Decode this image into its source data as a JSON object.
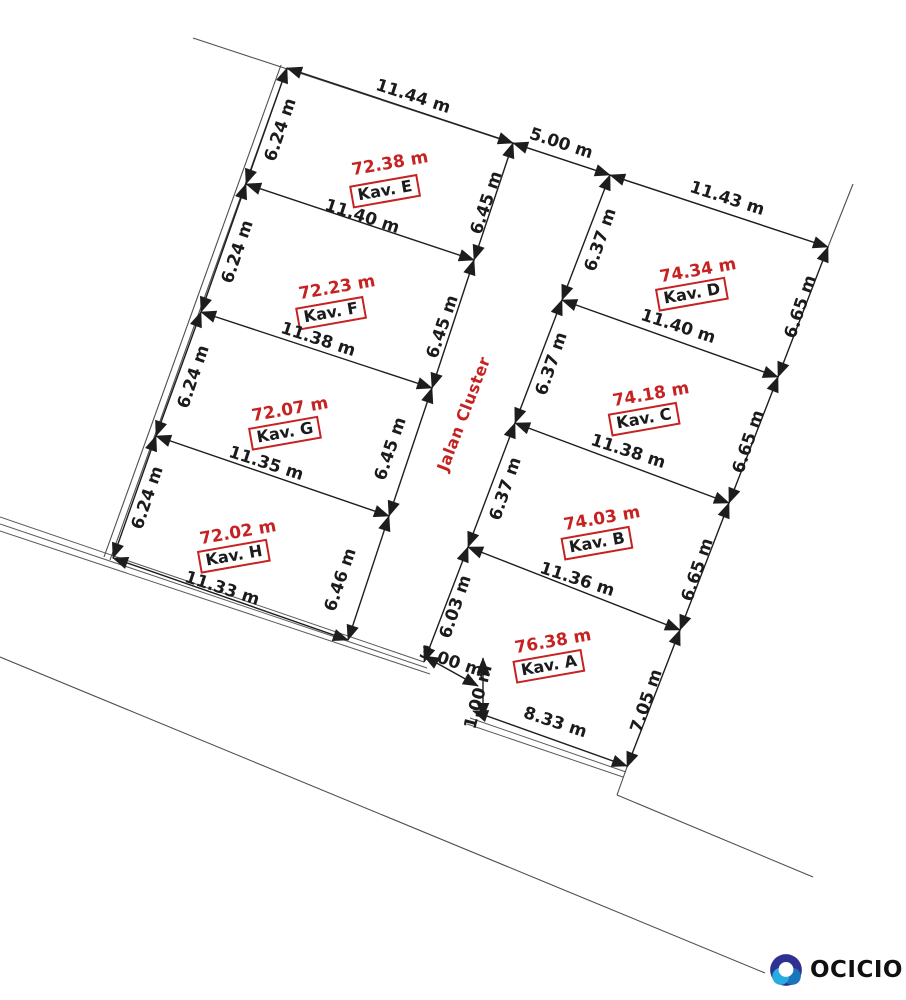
{
  "palette": {
    "accent": "#c62222",
    "text": "#1b1b1b",
    "line": "#4f4f4f",
    "logo_navy": "#2e3192",
    "logo_mid_blue": "#1b75bb",
    "logo_light_blue": "#29abe2"
  },
  "road": {
    "name": "Jalan Cluster",
    "top_width": "5.00 m",
    "bottom_width": "3.00 m",
    "edge_offset": "1.00 m"
  },
  "plots": {
    "E": {
      "kav": "Kav. E",
      "area": "72.38 m",
      "top": "11.44 m",
      "left": "6.24 m",
      "right": "6.45 m"
    },
    "F": {
      "kav": "Kav. F",
      "area": "72.23 m",
      "top": "11.40 m",
      "left": "6.24 m",
      "right": "6.45 m"
    },
    "G": {
      "kav": "Kav. G",
      "area": "72.07 m",
      "top": "11.38 m",
      "left": "6.24 m",
      "right": "6.45 m"
    },
    "H": {
      "kav": "Kav. H",
      "area": "72.02 m",
      "top": "11.35 m",
      "left": "6.24 m",
      "right": "6.46 m",
      "bottom": "11.33 m"
    },
    "D": {
      "kav": "Kav. D",
      "area": "74.34 m",
      "top": "11.43 m",
      "left": "6.37 m",
      "right": "6.65 m"
    },
    "C": {
      "kav": "Kav. C",
      "area": "74.18 m",
      "top": "11.40 m",
      "left": "6.37 m",
      "right": "6.65 m"
    },
    "B": {
      "kav": "Kav. B",
      "area": "74.03 m",
      "top": "11.38 m",
      "left": "6.37 m",
      "right": "6.65 m"
    },
    "A": {
      "kav": "Kav. A",
      "area": "76.38 m",
      "top": "11.36 m",
      "left": "6.03 m",
      "right": "7.05 m",
      "bottom": "8.33 m"
    }
  },
  "logo": {
    "text": "OCICIO"
  }
}
